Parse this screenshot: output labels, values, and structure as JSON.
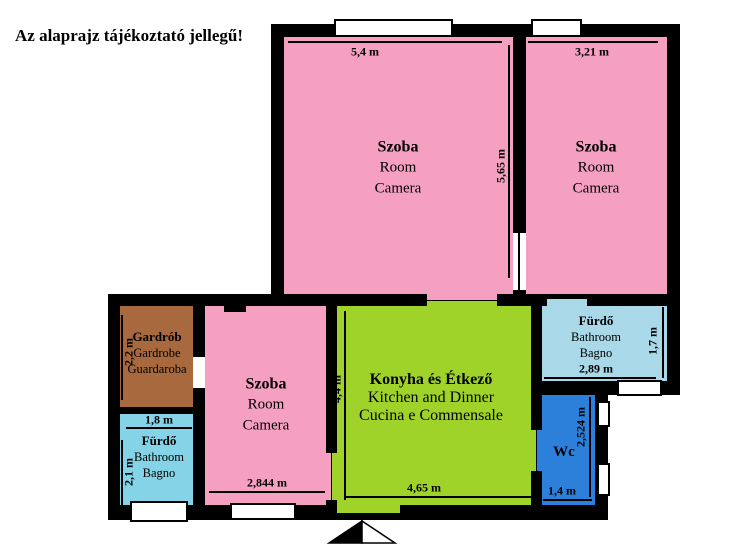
{
  "title": "Az alaprajz tájékoztató jellegű!",
  "colors": {
    "pink": "#F5A0C0",
    "green": "#9FD32A",
    "brown": "#A8693E",
    "cyan_left": "#85D3E6",
    "cyan_right": "#A9D9E8",
    "blue": "#2C80D9",
    "wall": "#000000"
  },
  "rooms": {
    "room_top_middle": {
      "lines": [
        "Szoba",
        "Room",
        "Camera"
      ],
      "dim_width": "5,4 m",
      "dim_height": "5,65 m"
    },
    "room_top_right": {
      "lines": [
        "Szoba",
        "Room",
        "Camera"
      ],
      "dim_width": "3,21 m"
    },
    "wardrobe": {
      "lines": [
        "Gardrób",
        "Gardrobe",
        "Guardaroba"
      ],
      "dim_height": "2,2 m"
    },
    "bathroom_left": {
      "lines": [
        "Fürdő",
        "Bathroom",
        "Bagno"
      ],
      "dim_width": "1,8 m",
      "dim_height": "2,1 m"
    },
    "room_bottom_left": {
      "lines": [
        "Szoba",
        "Room",
        "Camera"
      ],
      "dim_width": "2,844 m"
    },
    "kitchen": {
      "lines": [
        "Konyha és Étkező",
        "Kitchen and Dinner",
        "Cucina e Commensale"
      ],
      "dim_width": "4,65 m",
      "dim_height": "4,4 m"
    },
    "bathroom_right": {
      "lines": [
        "Fürdő",
        "Bathroom",
        "Bagno"
      ],
      "dim_width": "2,89 m",
      "dim_height": "1,7 m"
    },
    "wc": {
      "lines": [
        "Wc"
      ],
      "dim_width": "1,4 m",
      "dim_height": "2,524 m"
    }
  }
}
